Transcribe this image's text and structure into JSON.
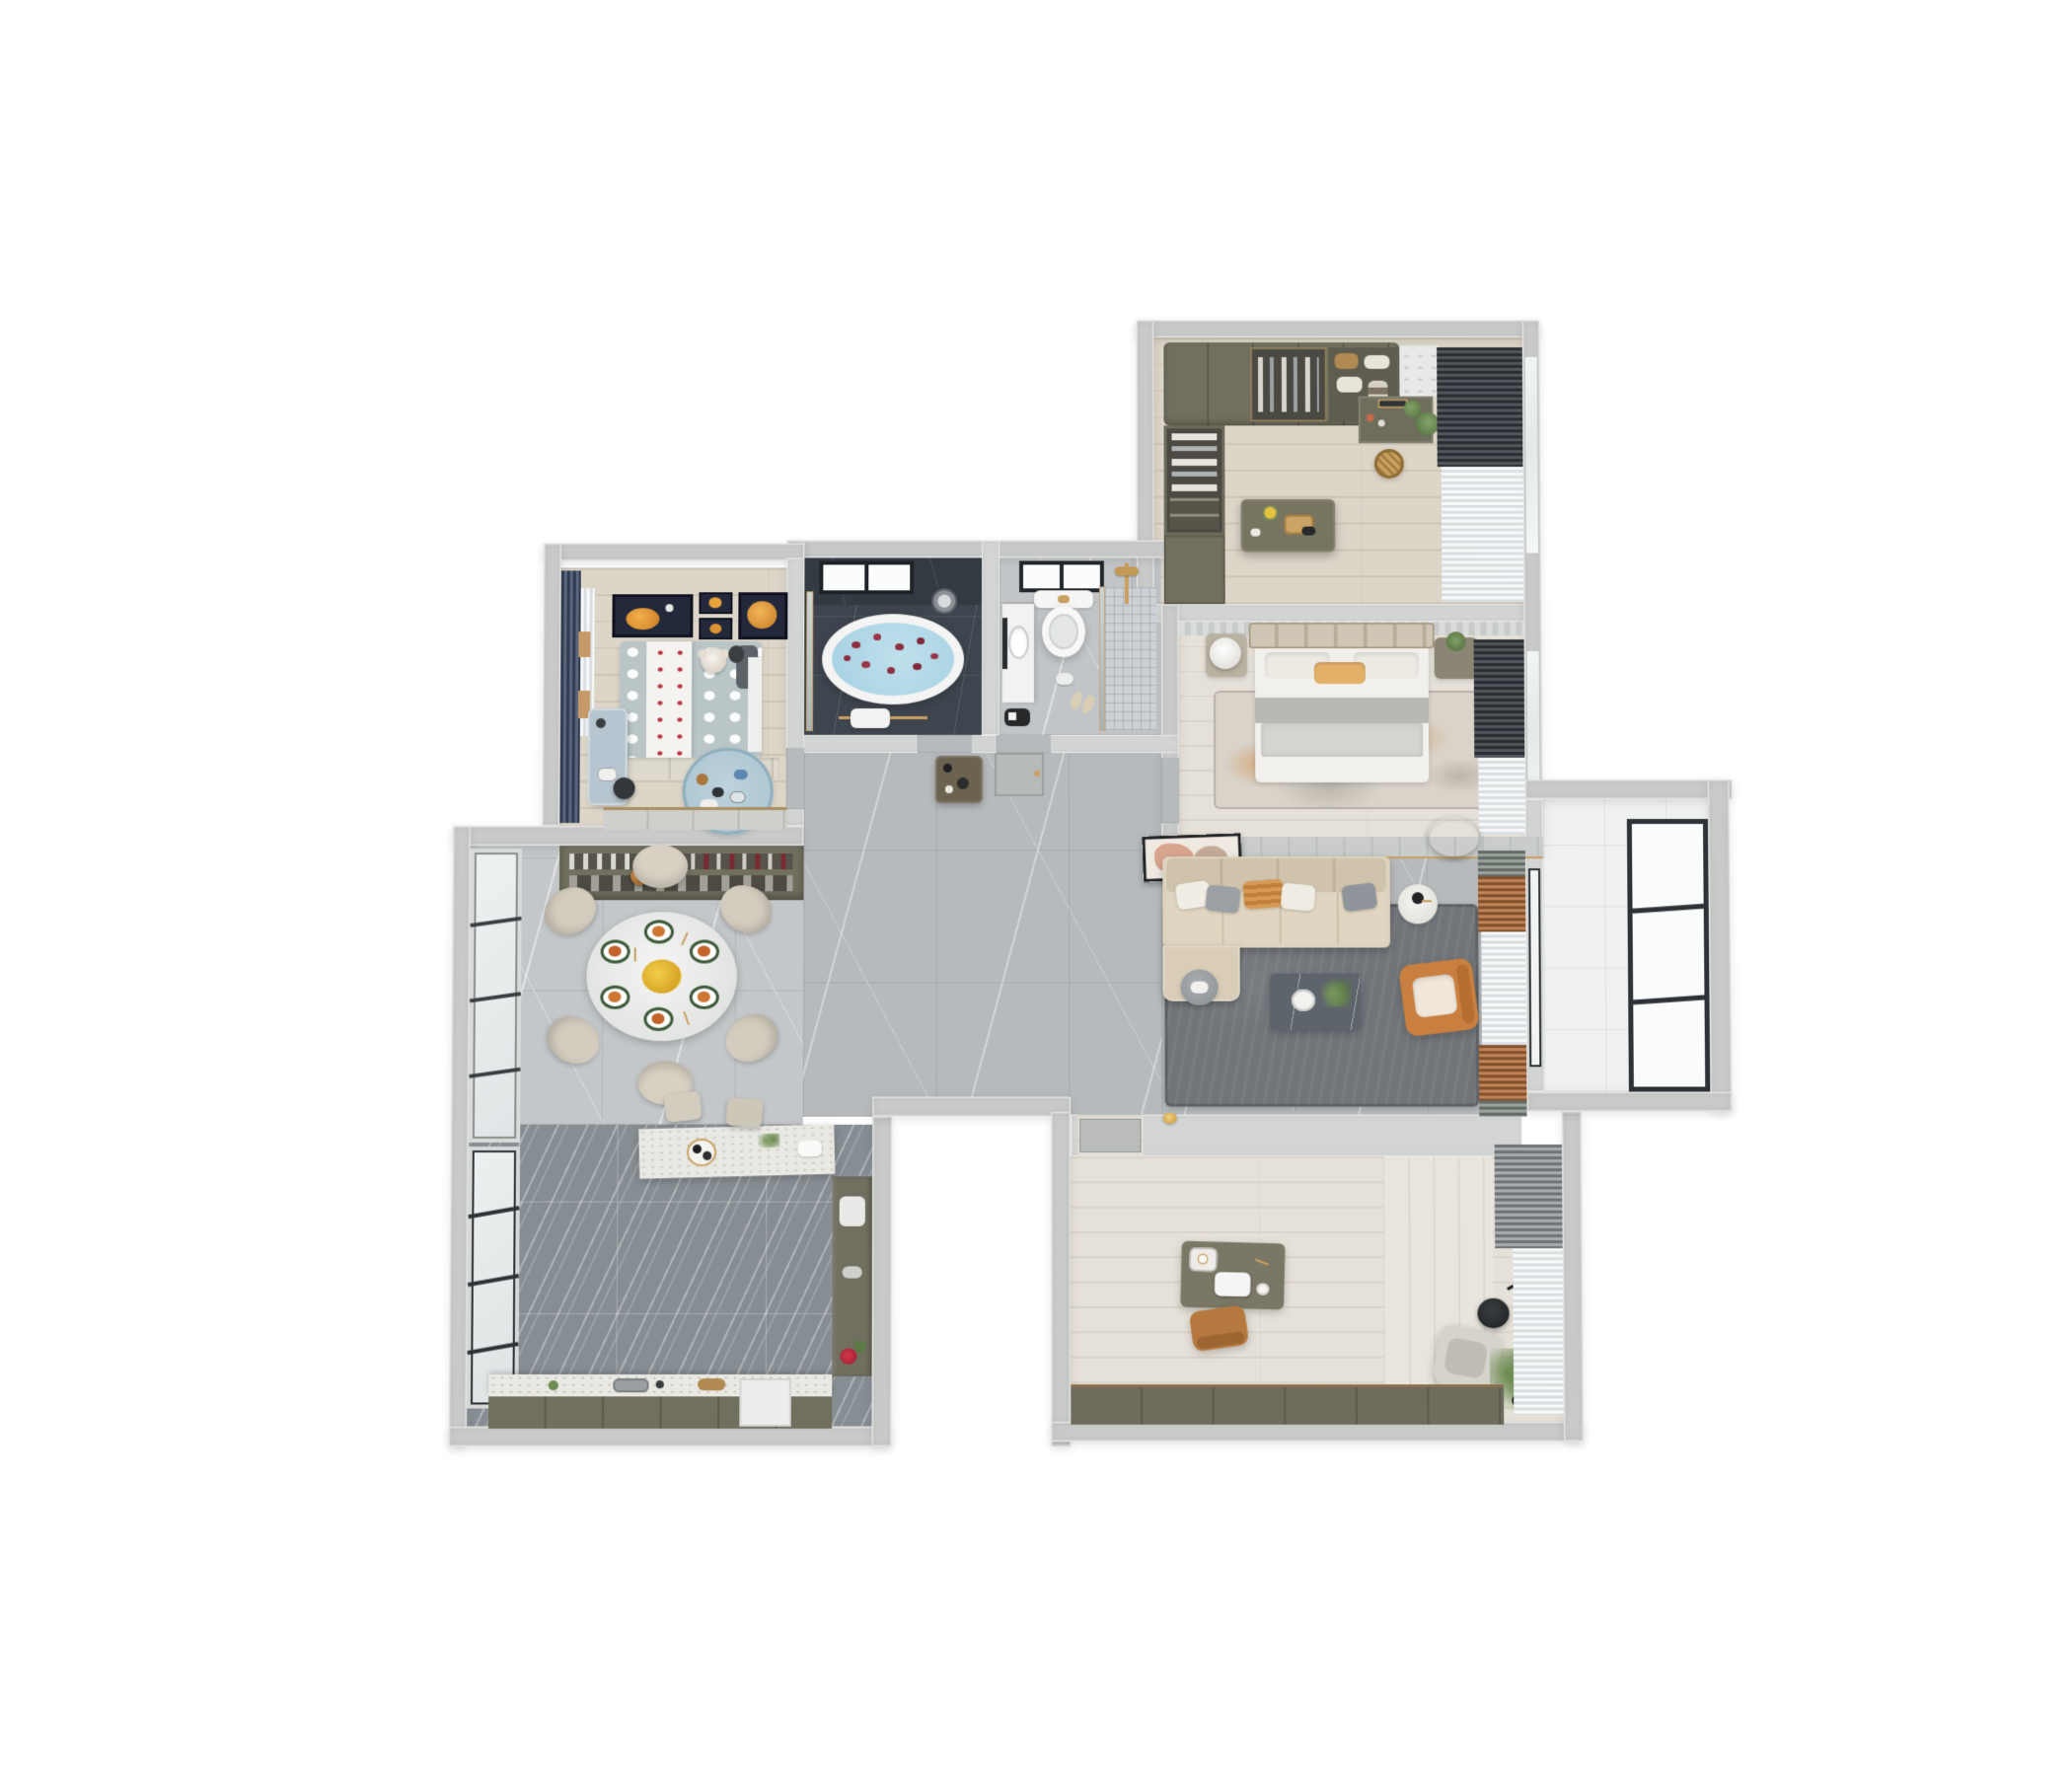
{
  "scene": {
    "type": "3d-floorplan-dollhouse-top-view",
    "description": "Photoreal top-down render of a furnished apartment on a white background",
    "palette": {
      "wall": "#c9cbca",
      "wood": "#dcd5c8",
      "woodWhite": "#e6e1d8",
      "marble": "#b7babc",
      "kitchen": "#878e93",
      "slate": "#3e454e",
      "slateWall": "#333a42",
      "water": "#a5d0e2",
      "petal": "#8e2f41",
      "gold": "#c9a063",
      "olive": "#716f5e",
      "oliveDark": "#5d5b4c",
      "sofa": "#d8ccb6",
      "cream": "#efece4",
      "rug": "#71757a",
      "orange": "#c97f3f",
      "rust": "#b5713f",
      "navy": "#41506b",
      "kidsBlue": "#a9c3cf",
      "kidsBed": "#b9c5c7",
      "greenC": "#8c958f",
      "charcoal": "#3a3f45",
      "sheer": "#e9edee",
      "plant": "#6b8457",
      "frame": "#2e3236"
    },
    "rooms": [
      {
        "name": "walk-in-closet",
        "items": [
          "olive-wardrobes",
          "open-closet-clothes",
          "dresser-island",
          "gold-tray",
          "flower-vase",
          "vanity-with-mirror",
          "green-plants",
          "rattan-basket",
          "charcoal-curtains",
          "windows"
        ]
      },
      {
        "name": "master-bedroom",
        "items": [
          "upholstered-bed",
          "white-duvet",
          "orange-lumbar-pillow",
          "nightstand-left",
          "white-drum-lamp",
          "nightstand-right",
          "plant",
          "distressed-orange-rug",
          "charcoal-curtains",
          "sheer-curtains",
          "ceiling-ring-light"
        ]
      },
      {
        "name": "bathroom-tub",
        "items": [
          "freestanding-oval-tub",
          "blue-water",
          "rose-petals",
          "black-frame-window",
          "rain-shower-head",
          "gold-towel-rail",
          "white-towel",
          "glass-partition"
        ]
      },
      {
        "name": "bathroom-shower",
        "items": [
          "wall-hung-toilet",
          "gold-flush-plate",
          "vanity-oval-basin",
          "walk-in-shower-mosaic",
          "gold-shower-set",
          "glass-divider",
          "window",
          "slippers",
          "gray-door"
        ]
      },
      {
        "name": "hallway",
        "items": [
          "console-table",
          "black-vases"
        ]
      },
      {
        "name": "kids-bedroom",
        "items": [
          "polka-dot-bed",
          "white-dot-runner",
          "teddy-bear",
          "dark-pillow",
          "wall-art-orange-moons-4x",
          "navy-curtains",
          "sheer-curtain",
          "study-desk",
          "desk-chair",
          "round-blue-rug",
          "toys",
          "wardrobe",
          "underbed-drawers"
        ]
      },
      {
        "name": "dining-room",
        "items": [
          "china-cabinet",
          "glassware",
          "wine-bottles",
          "copper-pendant",
          "tall-windows",
          "round-dining-table",
          "six-upholstered-chairs",
          "place-settings",
          "gold-cutlery",
          "yellow-flower-centerpiece"
        ]
      },
      {
        "name": "kitchen",
        "items": [
          "bar-counter-speckled-stone",
          "two-bar-stools",
          "round-serving-tray",
          "black-cups",
          "green-sprig",
          "dark-banded-tile-floor",
          "base-cabinets",
          "speckled-countertop",
          "sink",
          "tall-white-cabinet",
          "side-counter",
          "red-flowers",
          "dark-frame-windows"
        ]
      },
      {
        "name": "living-room",
        "items": [
          "tv-wall-paneling",
          "leaning-artwork",
          "l-shaped-beige-sofa",
          "throw-pillows-white-gray-orange",
          "gray-round-side-table",
          "white-drum-side-table",
          "dark-marble-coffee-table",
          "white-tray",
          "plant",
          "orange-leather-armchair",
          "dark-gray-area-rug",
          "ceiling-ring-light",
          "green-curtains",
          "rust-curtain-bands",
          "sheer-curtains",
          "gold-wall-sconce"
        ]
      },
      {
        "name": "balcony",
        "items": [
          "white-tile-floor",
          "full-height-window-three-panes",
          "sliding-door-frame"
        ]
      },
      {
        "name": "study",
        "items": [
          "writing-desk",
          "white-laptop",
          "breakfast-tray",
          "coffee-cup",
          "tan-task-chair",
          "gray-lounge-chair",
          "black-arc-floor-lamp",
          "black-side-table",
          "potted-plant",
          "low-olive-cabinet",
          "gray-curtains",
          "sheer-curtains",
          "door-mat"
        ]
      }
    ]
  }
}
